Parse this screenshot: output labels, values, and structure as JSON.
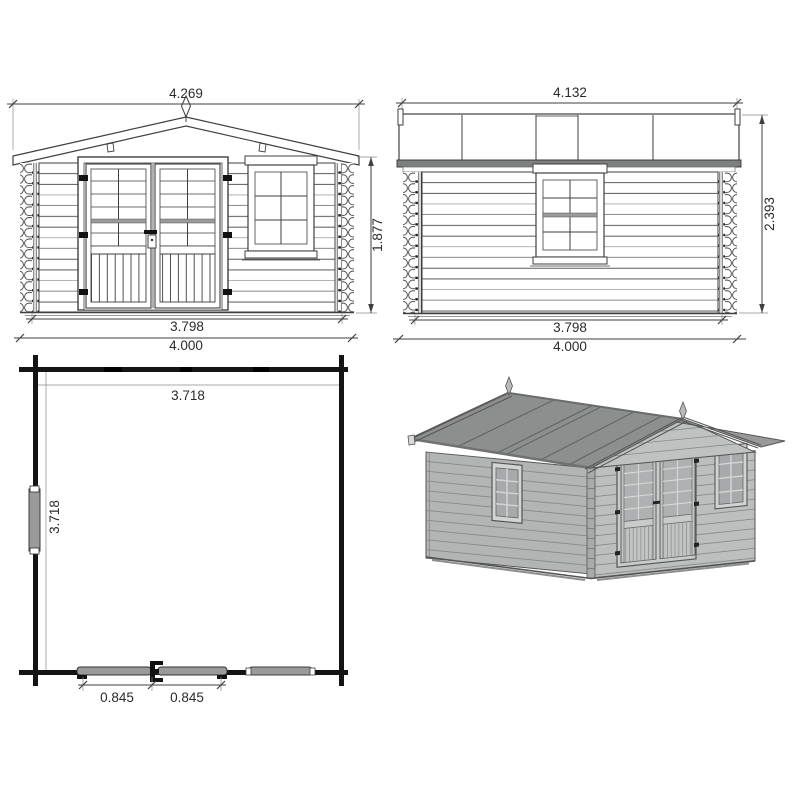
{
  "drawing": {
    "type": "log-cabin garden shed technical drawing, four views",
    "views": [
      "front elevation",
      "side elevation",
      "floor plan",
      "3d perspective"
    ]
  },
  "front_elevation": {
    "dim_overall_width": "4.269",
    "dim_height": "1.877",
    "dim_wall_width": "3.798",
    "dim_base_width": "4.000"
  },
  "side_elevation": {
    "dim_overall_width": "4.132",
    "dim_height": "2.393",
    "dim_wall_width": "3.798",
    "dim_base_width": "4.000"
  },
  "floor_plan": {
    "dim_inner_width": "3.718",
    "dim_inner_depth": "3.718",
    "dim_door_leaf_left": "0.845",
    "dim_door_leaf_right": "0.845"
  },
  "colors": {
    "line": "#3f3f3f",
    "dimension_text": "#2b2b2b",
    "roof_gray_3d": "#8d8f8f",
    "wall_gray_3d": "#b5b7b7",
    "plan_wall_black": "#141414",
    "fixture_gray": "#9a9a9a",
    "fascia_gray": "#7e8080"
  }
}
